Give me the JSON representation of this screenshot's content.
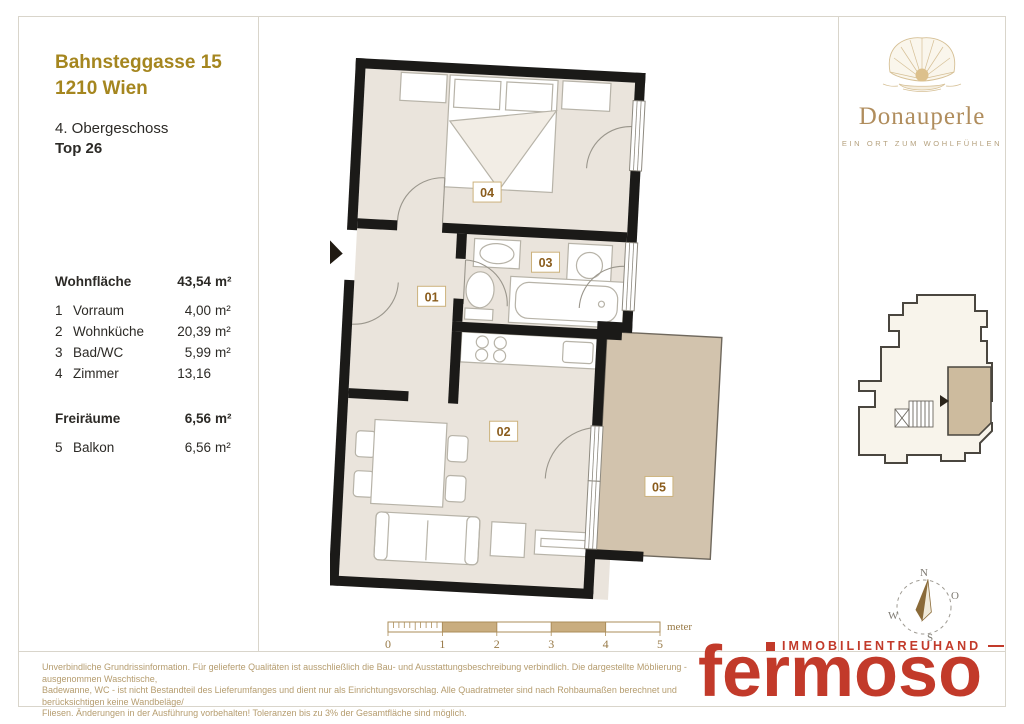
{
  "header": {
    "address_line1": "Bahnsteggasse 15",
    "address_line2": "1210 Wien",
    "floor": "4. Obergeschoss",
    "unit": "Top 26"
  },
  "table": {
    "wohn_label": "Wohnfläche",
    "wohn_num": "43,54",
    "wohn_unit": "m²",
    "rooms": [
      {
        "no": "1",
        "name": "Vorraum",
        "num": "4,00",
        "unit": "m²"
      },
      {
        "no": "2",
        "name": "Wohnküche",
        "num": "20,39",
        "unit": "m²"
      },
      {
        "no": "3",
        "name": "Bad/WC",
        "num": "5,99",
        "unit": "m²"
      },
      {
        "no": "4",
        "name": "Zimmer",
        "num": "13,16",
        "unit": ""
      }
    ],
    "frei_label": "Freiräume",
    "frei_num": "6,56",
    "frei_unit": "m²",
    "free_rooms": [
      {
        "no": "5",
        "name": "Balkon",
        "num": "6,56",
        "unit": "m²"
      }
    ]
  },
  "floorplan": {
    "labels": [
      "01",
      "02",
      "03",
      "04",
      "05"
    ],
    "colors": {
      "wall": "#1b1a18",
      "floor": "#eae4dc",
      "balcony": "#d2c3ad",
      "furniture": "#b7b3a8",
      "label_text": "#8a5c1c",
      "label_border": "#ccb27c"
    }
  },
  "scalebar": {
    "ticks": [
      "0",
      "1",
      "2",
      "3",
      "4",
      "5"
    ],
    "unit_label": "meter",
    "fill_color": "#c9ad7f",
    "line_color": "#ab8d5a"
  },
  "compass": {
    "n": "N",
    "e": "O",
    "s": "S",
    "w": "W"
  },
  "brand": {
    "name": "Donauperle",
    "tagline": "EIN ORT ZUM WOHLFÜHLEN",
    "accent": "#b08d5d"
  },
  "agency": {
    "line1": "IMMOBILIENTREUHAND",
    "name": "fermoso",
    "accent": "#c23a2a"
  },
  "disclaimer": {
    "line1": "Unverbindliche Grundrissinformation. Für gelieferte Qualitäten ist ausschließlich die Bau- und Ausstattungsbeschreibung verbindlich. Die dargestellte Möblierung - ausgenommen Waschtische,",
    "line2": "Badewanne, WC - ist nicht Bestandteil des Lieferumfanges und dient nur als Einrichtungsvorschlag. Alle Quadratmeter sind nach Rohbaumaßen berechnet und berücksichtigen keine Wandbeläge/",
    "line3": "Fliesen. Änderungen in der Ausführung vorbehalten! Toleranzen bis zu 3% der Gesamtfläche sind möglich."
  }
}
